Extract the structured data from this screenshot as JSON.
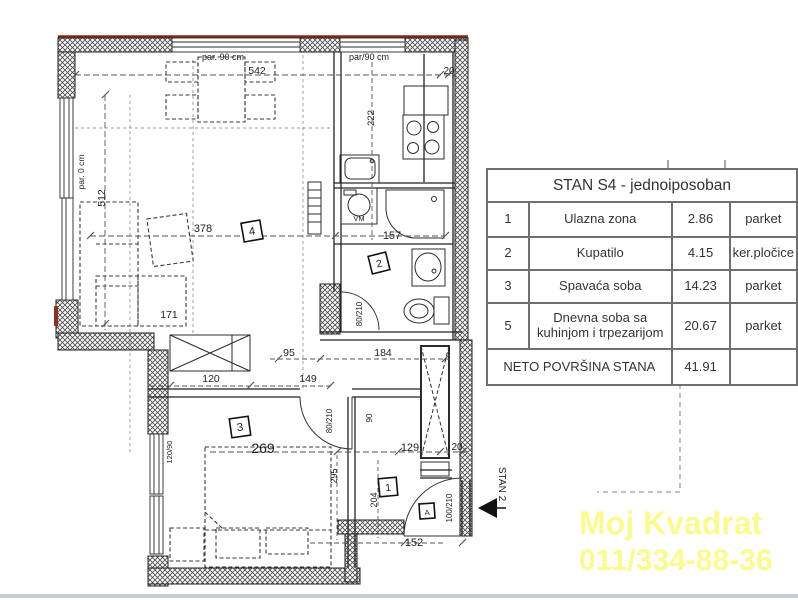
{
  "table": {
    "header": "STAN S4 - jednoiposoban",
    "rows": [
      {
        "num": "1",
        "name": "Ulazna zona",
        "area": "2.86",
        "floor": "parket"
      },
      {
        "num": "2",
        "name": "Kupatilo",
        "area": "4.15",
        "floor": "ker.pločice"
      },
      {
        "num": "3",
        "name": "Spavaća soba",
        "area": "14.23",
        "floor": "parket"
      },
      {
        "num": "5",
        "name": "Dnevna soba sa kuhinjom i trpezarijom",
        "area": "20.67",
        "floor": "parket"
      }
    ],
    "total": {
      "label": "NETO POVRŠINA STANA",
      "area": "41.91",
      "floor": ""
    }
  },
  "watermark": {
    "line1": "Moj Kvadrat",
    "line2": "011/334-88-36",
    "color": "#fbfa90"
  },
  "colors": {
    "wall_line": "#1f1f1f",
    "accent_red": "#7b2a1c",
    "bottom_bar": "#c6ced4",
    "dim_line": "#555555"
  },
  "plan": {
    "unit_arrow_label": "STAN 2",
    "labels": [
      {
        "text": "par. 90 cm",
        "x": 223,
        "y": 60,
        "rot": 0,
        "fs": 9
      },
      {
        "text": "542",
        "x": 257,
        "y": 74,
        "rot": 0,
        "fs": 10.5
      },
      {
        "text": "par/90 cm",
        "x": 369,
        "y": 60,
        "rot": 0,
        "fs": 9
      },
      {
        "text": "20",
        "x": 449,
        "y": 74,
        "rot": 0,
        "fs": 10
      },
      {
        "text": "222",
        "x": 374,
        "y": 118,
        "rot": -90,
        "fs": 9.5
      },
      {
        "text": "par. 0 cm",
        "x": 84,
        "y": 172,
        "rot": -90,
        "fs": 8.5
      },
      {
        "text": "512",
        "x": 105,
        "y": 198,
        "rot": -90,
        "fs": 10.5
      },
      {
        "text": "378",
        "x": 203,
        "y": 232,
        "rot": 0,
        "fs": 11
      },
      {
        "text": "157",
        "x": 392,
        "y": 239,
        "rot": 0,
        "fs": 11
      },
      {
        "text": "VM",
        "x": 359,
        "y": 221,
        "rot": 0,
        "fs": 7.5
      },
      {
        "text": "171",
        "x": 169,
        "y": 318,
        "rot": 0,
        "fs": 10.5
      },
      {
        "text": "80/210",
        "x": 362,
        "y": 314,
        "rot": -90,
        "fs": 8
      },
      {
        "text": "95",
        "x": 289,
        "y": 356,
        "rot": 0,
        "fs": 10.5
      },
      {
        "text": "184",
        "x": 383,
        "y": 356,
        "rot": 0,
        "fs": 10.5
      },
      {
        "text": "120",
        "x": 211,
        "y": 382,
        "rot": 0,
        "fs": 10.5
      },
      {
        "text": "149",
        "x": 308,
        "y": 382,
        "rot": 0,
        "fs": 10.5
      },
      {
        "text": "80/210",
        "x": 332,
        "y": 421,
        "rot": -90,
        "fs": 8
      },
      {
        "text": "90",
        "x": 372,
        "y": 418,
        "rot": -90,
        "fs": 8
      },
      {
        "text": "269",
        "x": 263,
        "y": 453,
        "rot": 0,
        "fs": 14
      },
      {
        "text": "129",
        "x": 410,
        "y": 451,
        "rot": 0,
        "fs": 11
      },
      {
        "text": "20",
        "x": 457,
        "y": 450,
        "rot": 0,
        "fs": 10
      },
      {
        "text": "295",
        "x": 337,
        "y": 476,
        "rot": -90,
        "fs": 9
      },
      {
        "text": "204",
        "x": 377,
        "y": 500,
        "rot": -90,
        "fs": 9
      },
      {
        "text": "120/90",
        "x": 172,
        "y": 452,
        "rot": -90,
        "fs": 7.5
      },
      {
        "text": "152",
        "x": 414,
        "y": 546,
        "rot": 0,
        "fs": 11
      },
      {
        "text": "100/210",
        "x": 452,
        "y": 508,
        "rot": -90,
        "fs": 8
      },
      {
        "text": "STAN 2",
        "x": 499,
        "y": 484,
        "rot": 90,
        "fs": 10
      }
    ],
    "markers": [
      {
        "text": "4",
        "x": 252,
        "y": 231,
        "rot": -10,
        "s": 19
      },
      {
        "text": "2",
        "x": 379,
        "y": 263,
        "rot": -14,
        "s": 18
      },
      {
        "text": "3",
        "x": 240,
        "y": 427,
        "rot": -8,
        "s": 19
      },
      {
        "text": "1",
        "x": 388,
        "y": 487,
        "rot": -5,
        "s": 18
      },
      {
        "text": "A",
        "x": 427,
        "y": 511,
        "rot": -4,
        "s": 15
      }
    ]
  }
}
